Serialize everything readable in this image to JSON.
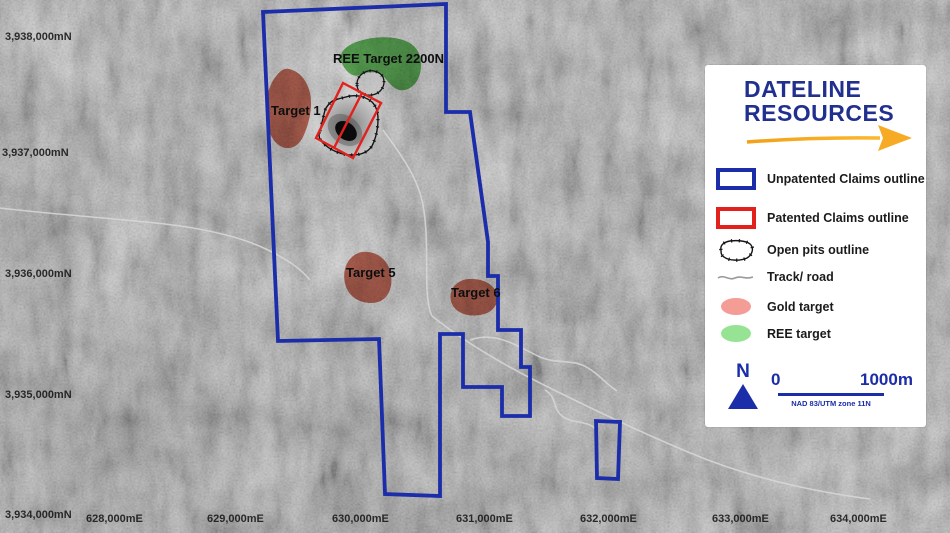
{
  "colors": {
    "claims_blue": "#1b2da8",
    "patented_red": "#e2211c",
    "gold_target_map": "#c24e36",
    "ree_target_map": "#44ad3c",
    "gold_target_legend": "#f49c96",
    "ree_target_legend": "#96e493",
    "logo_navy": "#21308f",
    "arrow_gold": "#f7ab24"
  },
  "logo": {
    "line1": "DATELINE",
    "line2": "RESOURCES"
  },
  "legend": {
    "items": [
      {
        "label": "Unpatented Claims outline"
      },
      {
        "label": "Patented Claims outline"
      },
      {
        "label": "Open pits outline"
      },
      {
        "label": "Track/ road"
      },
      {
        "label": "Gold target"
      },
      {
        "label": "REE target"
      }
    ],
    "north_label": "N",
    "scale": {
      "start": "0",
      "end": "1000m",
      "datum": "NAD 83/UTM zone 11N"
    }
  },
  "map": {
    "targets": [
      {
        "label": "REE Target 2200N"
      },
      {
        "label": "Target 1"
      },
      {
        "label": "Target 5"
      },
      {
        "label": "Target 6"
      }
    ],
    "northings": [
      "3,938,000mN",
      "3,937,000mN",
      "3,936,000mN",
      "3,935,000mN",
      "3,934,000mN"
    ],
    "eastings": [
      "628,000mE",
      "629,000mE",
      "630,000mE",
      "631,000mE",
      "632,000mE",
      "633,000mE",
      "634,000mE"
    ]
  }
}
